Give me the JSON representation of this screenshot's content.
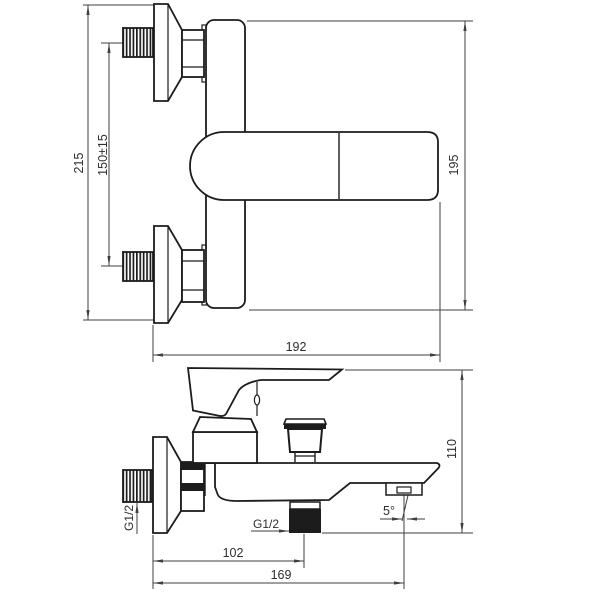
{
  "drawing": {
    "type": "bath-mixer-faucet-technical-drawing",
    "front_view": {
      "overall_height": "215",
      "inlet_spacing": "150±15",
      "body_height": "195",
      "overall_width": "192"
    },
    "side_view": {
      "overall_height": "110",
      "wall_to_outlet": "102",
      "wall_to_aerator": "169",
      "inlet_thread": "G1/2",
      "outlet_thread": "G1/2",
      "spout_angle": "5°"
    },
    "colors": {
      "outline": "#1c1c1c",
      "dimension": "#3f3f3f",
      "background": "#ffffff"
    }
  }
}
